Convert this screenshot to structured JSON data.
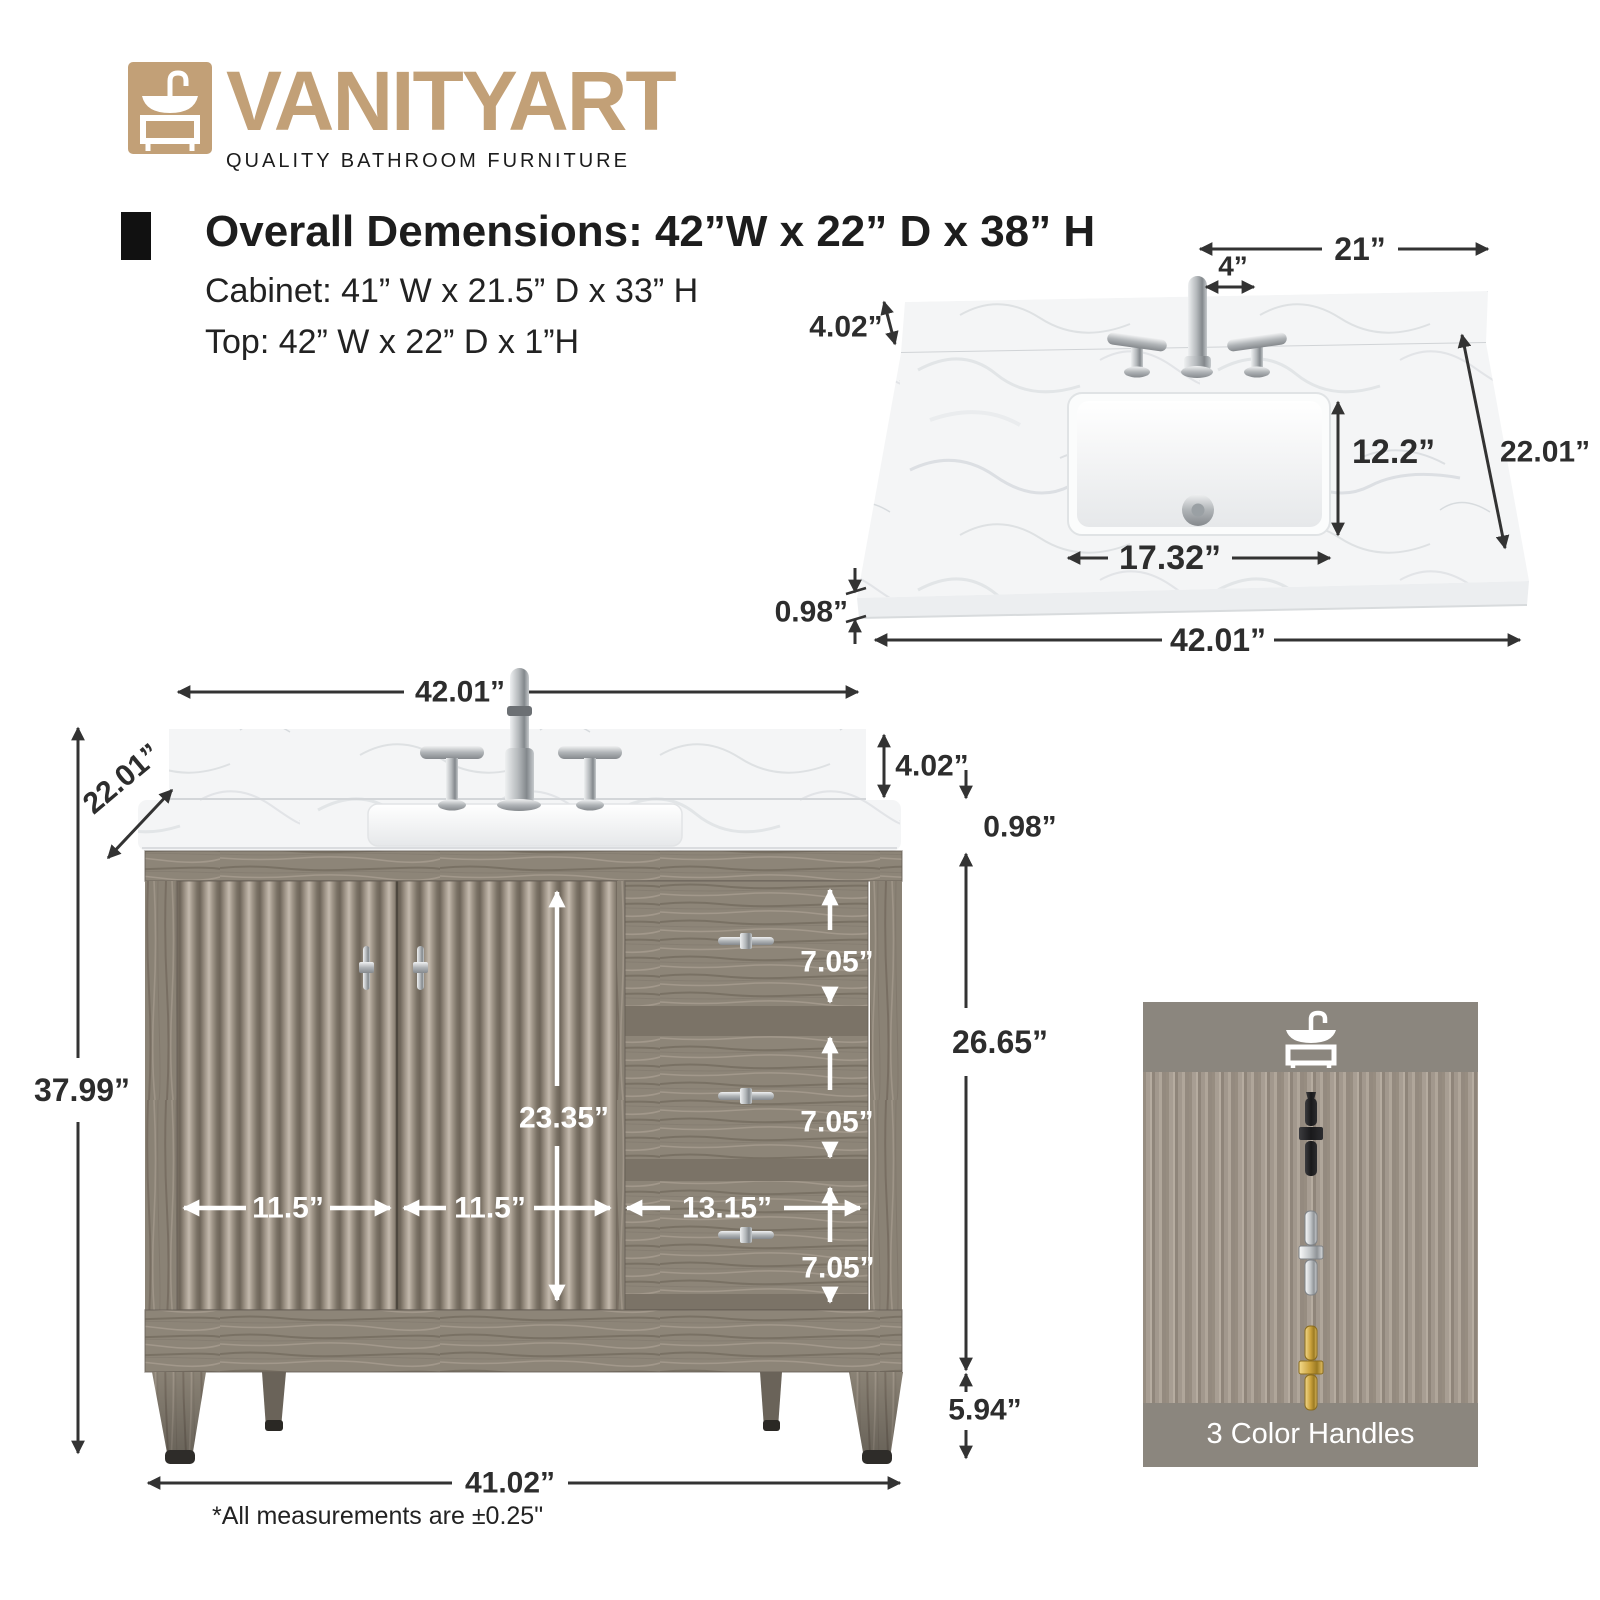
{
  "brand": {
    "name": "VANITYART",
    "tagline": "QUALITY BATHROOM FURNITURE"
  },
  "specs": {
    "overall": "Overall Demensions: 42”W x 22” D x 38” H",
    "cabinet": "Cabinet: 41” W x 21.5” D x 33” H",
    "top": "Top: 42” W x 22” D x 1”H"
  },
  "top_view": {
    "half_width": "21”",
    "faucet_spread": "4”",
    "backsplash_height": "4.02”",
    "sink_depth": "12.2”",
    "depth": "22.01”",
    "sink_width": "17.32”",
    "thickness": "0.98”",
    "width": "42.01”"
  },
  "front_view": {
    "width": "42.01”",
    "depth": "22.01”",
    "backsplash_height": "4.02”",
    "thickness": "0.98”",
    "height": "37.99”",
    "door_height": "23.35”",
    "left_door_width": "11.5”",
    "right_door_width": "11.5”",
    "top_drawer_height": "7.05”",
    "middle_drawer_height": "7.05”",
    "bottom_drawer_height": "7.05”",
    "drawer_width": "13.15”",
    "body_height": "26.65”",
    "leg_height": "5.94”",
    "base_width": "41.02”"
  },
  "handles_panel": {
    "caption": "3 Color Handles Selection",
    "options": [
      "Black",
      "Chrome",
      "Gold"
    ]
  },
  "footnote": "*All measurements are ±0.25\"",
  "colors": {
    "brand_gold": "#c2a077",
    "dimension_text": "#2d2d2d",
    "white_label": "#ffffff",
    "panel_gray": "#8b867e",
    "handle_black": "#1d1d1f",
    "handle_chrome": "#d9dcde",
    "handle_gold": "#c9a24a"
  }
}
